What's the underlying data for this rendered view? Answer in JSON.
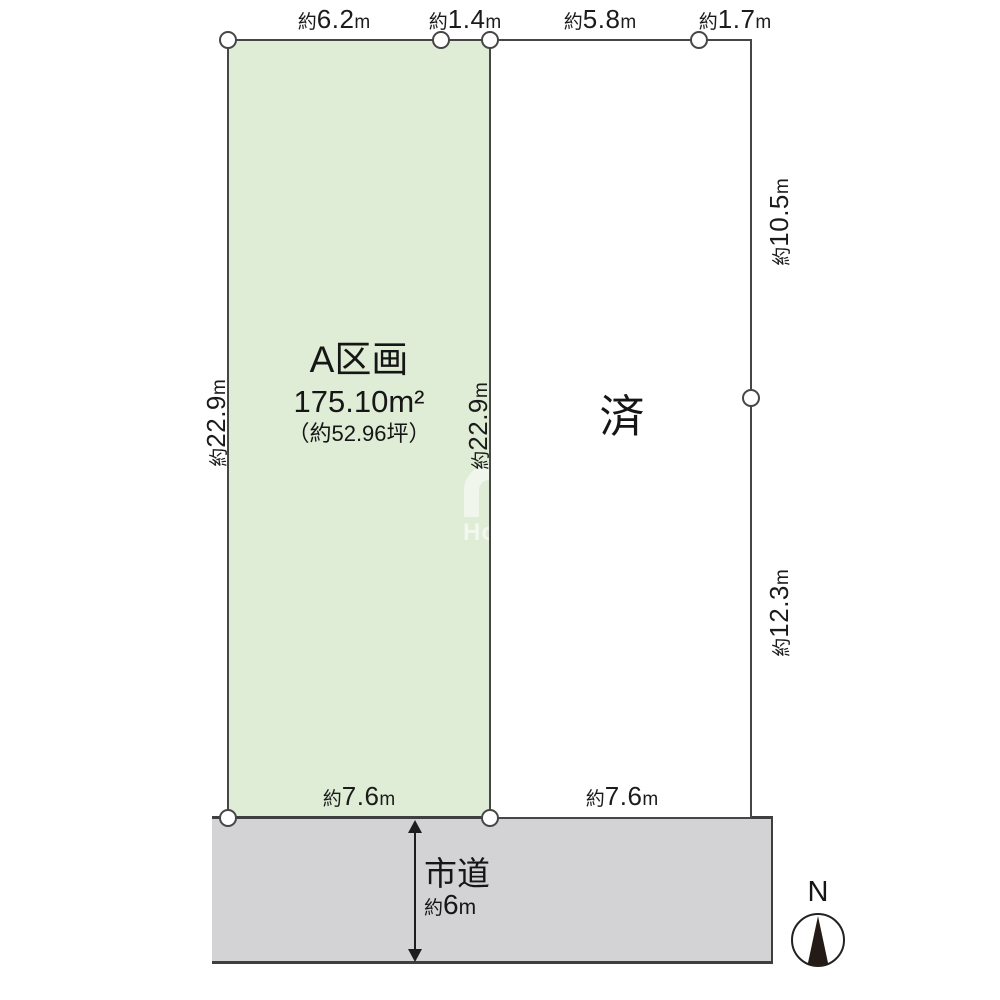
{
  "colors": {
    "plot_a_fill": "#dfecd6",
    "road_fill": "#d3d3d5",
    "line": "#464646",
    "compass_needle": "#241b17"
  },
  "plot_a": {
    "name": "A区画",
    "area_value": "175.10",
    "area_unit": "m²",
    "tsubo": "（約52.96坪）"
  },
  "plot_b": {
    "status": "済"
  },
  "dims": {
    "top": [
      {
        "p": "約",
        "v": "6.2",
        "u": "m"
      },
      {
        "p": "約",
        "v": "1.4",
        "u": "m"
      },
      {
        "p": "約",
        "v": "5.8",
        "u": "m"
      },
      {
        "p": "約",
        "v": "1.7",
        "u": "m"
      }
    ],
    "left": {
      "p": "約",
      "v": "22.9",
      "u": "m"
    },
    "middle": {
      "p": "約",
      "v": "22.9",
      "u": "m"
    },
    "right_upper": {
      "p": "約",
      "v": "10.5",
      "u": "m"
    },
    "right_lower": {
      "p": "約",
      "v": "12.3",
      "u": "m"
    },
    "bottom_left": {
      "p": "約",
      "v": "7.6",
      "u": "m"
    },
    "bottom_right": {
      "p": "約",
      "v": "7.6",
      "u": "m"
    }
  },
  "road": {
    "name": "市道",
    "width_p": "約",
    "width_v": "6",
    "width_u": "m"
  },
  "compass": {
    "north_label": "N"
  },
  "watermark": {
    "text": "Ho"
  }
}
